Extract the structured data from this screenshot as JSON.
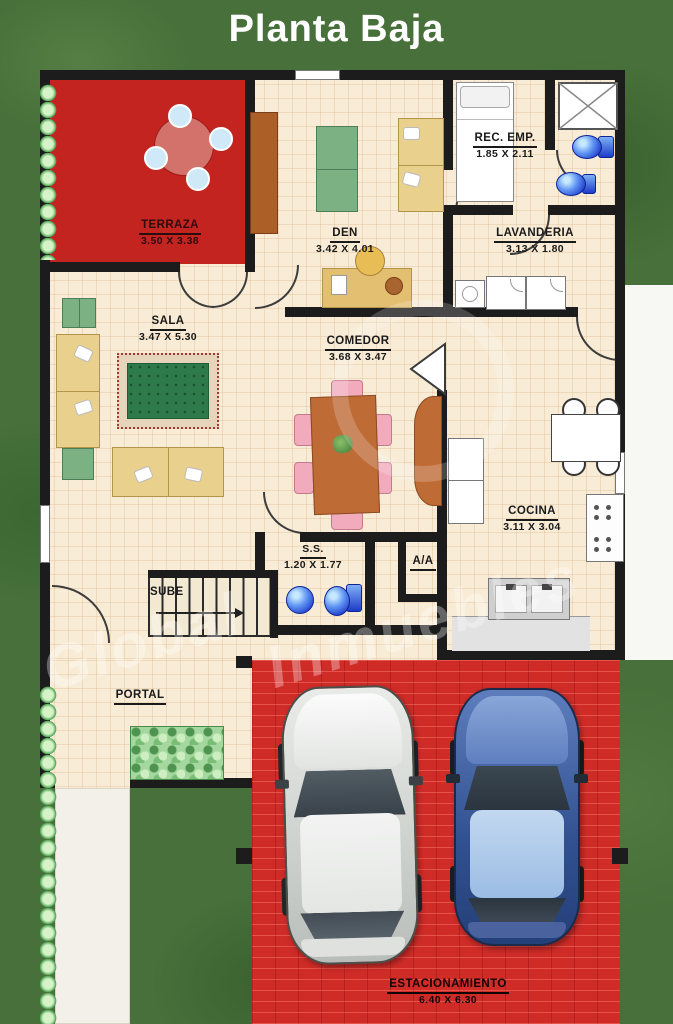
{
  "title": "Planta Baja",
  "watermark": {
    "line1": "Global",
    "line2": "Inmuebles"
  },
  "rooms": {
    "terraza": {
      "name": "TERRAZA",
      "dims": "3.50 X 3.38"
    },
    "den": {
      "name": "DEN",
      "dims": "3.42 X 4.01"
    },
    "rec_emp": {
      "name": "REC. EMP.",
      "dims": "1.85 X 2.11"
    },
    "lavanderia": {
      "name": "LAVANDERIA",
      "dims": "3.13 X 1.80"
    },
    "sala": {
      "name": "SALA",
      "dims": "3.47 X 5.30"
    },
    "comedor": {
      "name": "COMEDOR",
      "dims": "3.68 X 3.47"
    },
    "cocina": {
      "name": "COCINA",
      "dims": "3.11 X 3.04"
    },
    "ss": {
      "name": "S.S.",
      "dims": "1.20 X 1.77"
    },
    "aa": {
      "name": "A/A"
    },
    "stairs": {
      "name": "SUBE"
    },
    "portal": {
      "name": "PORTAL"
    },
    "estacionamiento": {
      "name": "ESTACIONAMIENTO",
      "dims": "6.40 X 6.30"
    }
  },
  "colors": {
    "grass": "#47703a",
    "terraza_red": "#c42420",
    "parking_red": "#cf2c28",
    "floor_cream": "#f8ecd6",
    "wall_black": "#1c1c1c",
    "fixture_blue": "#2b4bd8",
    "wood_brown": "#bf6b36",
    "sofa_tan": "#e9d08d",
    "rug_green": "#2e7a4b",
    "hedge_green": "#8fcf8c",
    "car_white": "#e9ebe9",
    "car_blue": "#5d7dbd",
    "title_text": "#ffffff",
    "label_text": "#1a1a1a"
  }
}
